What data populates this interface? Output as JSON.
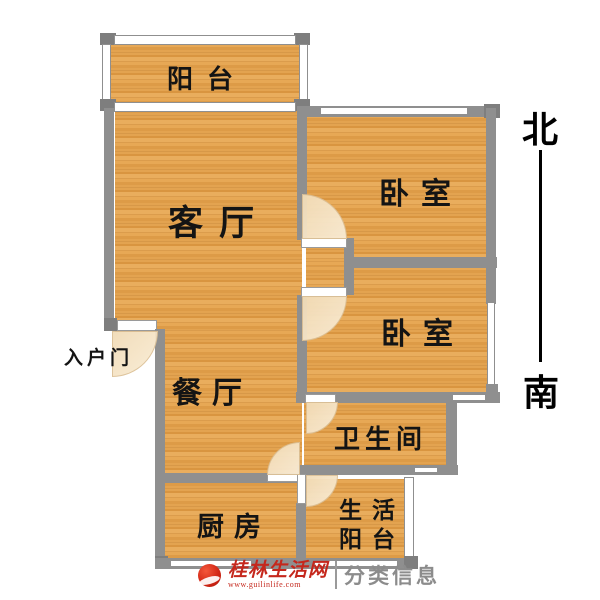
{
  "rooms": {
    "balcony": {
      "label": "阳台"
    },
    "living": {
      "label": "客厅"
    },
    "bedroom1": {
      "label": "卧室"
    },
    "bedroom2": {
      "label": "卧室"
    },
    "dining": {
      "label": "餐厅"
    },
    "bathroom": {
      "label": "卫生间"
    },
    "kitchen": {
      "label": "厨房"
    },
    "utility_balcony": {
      "label_line1": "生活",
      "label_line2": "阳台"
    }
  },
  "entrance": {
    "label": "入户门"
  },
  "compass": {
    "north": "北",
    "south": "南"
  },
  "watermark": {
    "site_name": "桂林生活网",
    "site_url": "www.guilinlife.com",
    "category_text": "分类信息"
  },
  "colors": {
    "floor_base": "#e2a252",
    "wall": "#8f8f8f",
    "door_arc": "#f6e3c4",
    "watermark_red": "#c5271c",
    "watermark_gray": "#8c8c8c"
  }
}
